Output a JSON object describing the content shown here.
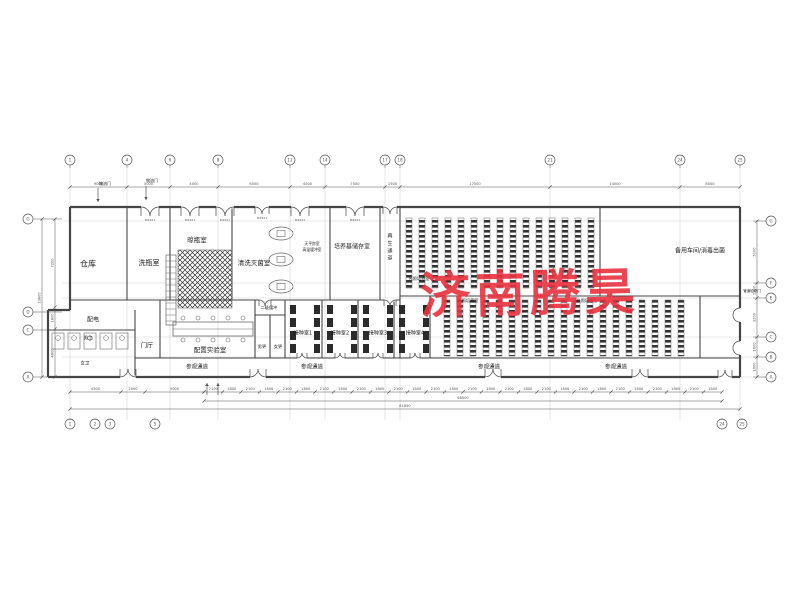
{
  "watermark": {
    "text": "济南腾昊",
    "color": "#ea3140"
  },
  "plan": {
    "colors": {
      "wall": "#454545",
      "thin": "#6a6a6a",
      "grid": "#c9c9c9",
      "dim": "#555555",
      "text": "#1a1a1a",
      "hatch": "#333333"
    },
    "door_tag": "M1521",
    "axes": {
      "top": {
        "y": 160,
        "items": [
          {
            "x": 70,
            "l": "1"
          },
          {
            "x": 127,
            "l": "4"
          },
          {
            "x": 170,
            "l": "6"
          },
          {
            "x": 218,
            "l": "8"
          },
          {
            "x": 290,
            "l": "12"
          },
          {
            "x": 325,
            "l": "14"
          },
          {
            "x": 385,
            "l": "17"
          },
          {
            "x": 400,
            "l": "18"
          },
          {
            "x": 550,
            "l": "21"
          },
          {
            "x": 680,
            "l": "24"
          },
          {
            "x": 740,
            "l": "25"
          }
        ]
      },
      "bottom": {
        "y": 424,
        "items": [
          {
            "x": 70,
            "l": "1"
          },
          {
            "x": 95,
            "l": "2"
          },
          {
            "x": 110,
            "l": "3"
          },
          {
            "x": 155,
            "l": "5"
          },
          {
            "x": 722,
            "l": "24"
          },
          {
            "x": 742,
            "l": "25"
          }
        ]
      },
      "left": {
        "x": 28,
        "items": [
          {
            "y": 219,
            "l": "G"
          },
          {
            "y": 312,
            "l": "D"
          },
          {
            "y": 330,
            "l": "C"
          },
          {
            "y": 377,
            "l": "A"
          }
        ]
      },
      "right": {
        "x": 771,
        "items": [
          {
            "y": 221,
            "l": "G"
          },
          {
            "y": 283,
            "l": "F"
          },
          {
            "y": 298,
            "l": "E"
          },
          {
            "y": 337,
            "l": "C"
          },
          {
            "y": 357,
            "l": "B"
          },
          {
            "y": 377,
            "l": "A"
          }
        ]
      }
    },
    "dims": {
      "top": {
        "y": 187,
        "xs": [
          70,
          127,
          170,
          218,
          290,
          325,
          385,
          400,
          550,
          680,
          740
        ],
        "labels": [
          "9000",
          "5000",
          "4000",
          "6000",
          "4500",
          "7500",
          "1500",
          "17500",
          "14000",
          "8000"
        ]
      },
      "bottom_left": {
        "y": 392,
        "xs": [
          70,
          121,
          145,
          204
        ],
        "labels": [
          "4300",
          "2000",
          "5000"
        ]
      },
      "bottom_fine": {
        "y": 392,
        "x1": 204,
        "x2": 722,
        "n": 28,
        "alt": [
          "2100",
          "1800"
        ]
      },
      "bottom_mid": {
        "y": 401,
        "xs": [
          204,
          722
        ],
        "labels": [
          "68500"
        ]
      },
      "bottom_total": {
        "y": 409,
        "xs": [
          70,
          740
        ],
        "labels": [
          "81850"
        ]
      },
      "left": {
        "x": 55,
        "ys": [
          219,
          307,
          329,
          377
        ],
        "labels": [
          "7200",
          "1800",
          "4800"
        ]
      },
      "left_total": {
        "x": 42,
        "ys": [
          219,
          377
        ],
        "labels": [
          "13800"
        ]
      },
      "right": {
        "x": 757,
        "ys": [
          221,
          283,
          298,
          337,
          357,
          377
        ],
        "labels": [
          "5100",
          "1200",
          "3200",
          "1600",
          "1600"
        ]
      }
    },
    "walls": [
      [
        70,
        207,
        740,
        207,
        1
      ],
      [
        740,
        207,
        740,
        377,
        1
      ],
      [
        70,
        377,
        740,
        377,
        1
      ],
      [
        70,
        207,
        70,
        310,
        1
      ],
      [
        48,
        310,
        70,
        310,
        1
      ],
      [
        48,
        310,
        48,
        377,
        1
      ],
      [
        48,
        377,
        70,
        377,
        1
      ],
      [
        127,
        207,
        127,
        300,
        0
      ],
      [
        170,
        207,
        170,
        300,
        0
      ],
      [
        232,
        207,
        232,
        300,
        0
      ],
      [
        330,
        207,
        330,
        300,
        0
      ],
      [
        380,
        207,
        380,
        300,
        0
      ],
      [
        400,
        207,
        400,
        358,
        0
      ],
      [
        600,
        207,
        600,
        296,
        0
      ],
      [
        70,
        300,
        400,
        300,
        0
      ],
      [
        400,
        296,
        740,
        296,
        0
      ],
      [
        135,
        310,
        135,
        377,
        0
      ],
      [
        48,
        330,
        135,
        330,
        0
      ],
      [
        160,
        300,
        160,
        358,
        0
      ],
      [
        255,
        300,
        255,
        358,
        0
      ],
      [
        285,
        300,
        285,
        358,
        0
      ],
      [
        322,
        300,
        322,
        358,
        0
      ],
      [
        358,
        300,
        358,
        358,
        0
      ],
      [
        394,
        300,
        394,
        358,
        0
      ],
      [
        430,
        296,
        430,
        358,
        0
      ],
      [
        700,
        296,
        700,
        358,
        0
      ],
      [
        255,
        315,
        285,
        315,
        0
      ],
      [
        270,
        315,
        270,
        358,
        0
      ],
      [
        135,
        358,
        740,
        358,
        0
      ]
    ],
    "racks": {
      "groups": [
        {
          "x1": 406,
          "x2": 594,
          "y1": 218,
          "y2": 288,
          "pitch": 13,
          "w": 6
        },
        {
          "x1": 444,
          "x2": 688,
          "y1": 300,
          "y2": 356,
          "pitch": 13,
          "w": 6
        }
      ]
    },
    "fixtures": {
      "crosshatch": {
        "x": 178,
        "y": 250,
        "w": 54,
        "h": 58
      },
      "ladders": [
        {
          "x": 166,
          "y": 255,
          "w": 10,
          "h": 70
        }
      ],
      "bench": {
        "x": 173,
        "y": 322,
        "w": 80,
        "h": 14
      },
      "autoclaves": [
        {
          "x": 269,
          "y": 227,
          "w": 24,
          "h": 13
        },
        {
          "x": 269,
          "y": 253,
          "w": 24,
          "h": 13
        },
        {
          "x": 269,
          "y": 280,
          "w": 24,
          "h": 13
        }
      ],
      "stalls": {
        "x": 52,
        "y": 333,
        "n": 5,
        "pitch": 16,
        "w": 12,
        "h": 16
      },
      "benches_small": {
        "rooms": [
          287,
          324,
          360,
          396
        ],
        "cols": [
          3,
          27
        ],
        "y": 305,
        "n": 4,
        "pitch": 13,
        "w": 6,
        "h": 9
      }
    },
    "doors": [
      {
        "x": 150,
        "y": 207,
        "o": "d",
        "w": 9,
        "tag": 1
      },
      {
        "x": 190,
        "y": 207,
        "o": "d",
        "w": 9,
        "tag": 1
      },
      {
        "x": 225,
        "y": 207,
        "o": "d",
        "w": 9,
        "tag": 1
      },
      {
        "x": 262,
        "y": 207,
        "o": "d",
        "w": 7,
        "tag": 1
      },
      {
        "x": 300,
        "y": 207,
        "o": "d",
        "w": 9,
        "tag": 1
      },
      {
        "x": 355,
        "y": 207,
        "o": "d",
        "w": 9,
        "tag": 1
      },
      {
        "x": 390,
        "y": 207,
        "o": "d",
        "w": 7,
        "tag": 0
      },
      {
        "x": 128,
        "y": 377,
        "o": "u",
        "w": 8,
        "tag": 0
      },
      {
        "x": 258,
        "y": 377,
        "o": "u",
        "w": 8,
        "tag": 0
      },
      {
        "x": 493,
        "y": 377,
        "o": "u",
        "w": 8,
        "tag": 0
      },
      {
        "x": 640,
        "y": 377,
        "o": "u",
        "w": 8,
        "tag": 0
      },
      {
        "x": 725,
        "y": 377,
        "o": "u",
        "w": 7,
        "tag": 0
      },
      {
        "x": 740,
        "y": 315,
        "o": "l",
        "w": 7,
        "tag": 0
      },
      {
        "x": 740,
        "y": 348,
        "o": "l",
        "w": 7,
        "tag": 0
      },
      {
        "x": 265,
        "y": 300,
        "o": "d",
        "w": 6,
        "tag": 0
      },
      {
        "x": 390,
        "y": 300,
        "o": "d",
        "w": 6,
        "tag": 0
      },
      {
        "x": 302,
        "y": 358,
        "o": "u",
        "w": 5,
        "tag": 0
      },
      {
        "x": 340,
        "y": 358,
        "o": "u",
        "w": 5,
        "tag": 0
      },
      {
        "x": 378,
        "y": 358,
        "o": "u",
        "w": 5,
        "tag": 0
      },
      {
        "x": 415,
        "y": 358,
        "o": "u",
        "w": 5,
        "tag": 0
      }
    ],
    "arrows": [
      {
        "x1": 98,
        "y1": 188,
        "x2": 98,
        "y2": 202
      },
      {
        "x1": 146,
        "y1": 186,
        "x2": 146,
        "y2": 200
      },
      {
        "x1": 207,
        "y1": 395,
        "x2": 207,
        "y2": 383
      },
      {
        "x1": 218,
        "y1": 395,
        "x2": 218,
        "y2": 383
      }
    ],
    "labels": [
      {
        "t": "仓库",
        "x": 88,
        "y": 264,
        "s": 8
      },
      {
        "t": "洗瓶室",
        "x": 149,
        "y": 263,
        "s": 7
      },
      {
        "t": "晾瓶室",
        "x": 197,
        "y": 240,
        "s": 6.5
      },
      {
        "t": "清洗灭菌室",
        "x": 254,
        "y": 263,
        "s": 6.5
      },
      {
        "t": "天平房室",
        "x": 312,
        "y": 244,
        "s": 3.8
      },
      {
        "t": "高温缓冲室",
        "x": 312,
        "y": 250,
        "s": 3.8
      },
      {
        "t": "培养基储存室",
        "x": 352,
        "y": 247,
        "s": 6
      },
      {
        "t": "再生通道",
        "x": 390,
        "y": 236,
        "s": 5,
        "v": 1
      },
      {
        "t": "光照培养室",
        "x": 419,
        "y": 279,
        "s": 4.2
      },
      {
        "t": "光照培养室",
        "x": 468,
        "y": 301,
        "s": 4.2
      },
      {
        "t": "光照培养室",
        "x": 587,
        "y": 301,
        "s": 4.2
      },
      {
        "t": "备用车间/消毒出菌",
        "x": 700,
        "y": 251,
        "s": 6
      },
      {
        "t": "配电",
        "x": 93,
        "y": 320,
        "s": 6
      },
      {
        "t": "男卫",
        "x": 88,
        "y": 338,
        "s": 4.5
      },
      {
        "t": "女卫",
        "x": 85,
        "y": 363,
        "s": 4.5
      },
      {
        "t": "门厅",
        "x": 147,
        "y": 346,
        "s": 6
      },
      {
        "t": "配置实验室",
        "x": 210,
        "y": 350,
        "s": 6.5
      },
      {
        "t": "二级缓冲",
        "x": 269,
        "y": 308,
        "s": 4.2
      },
      {
        "t": "男更",
        "x": 262,
        "y": 347,
        "s": 4.2
      },
      {
        "t": "女更",
        "x": 278,
        "y": 347,
        "s": 4.2
      },
      {
        "t": "接种室1",
        "x": 303,
        "y": 333,
        "s": 5
      },
      {
        "t": "接种室2",
        "x": 340,
        "y": 333,
        "s": 5
      },
      {
        "t": "接种室3",
        "x": 378,
        "y": 333,
        "s": 5
      },
      {
        "t": "接种室4",
        "x": 415,
        "y": 333,
        "s": 5
      },
      {
        "t": "参观通道",
        "x": 197,
        "y": 367,
        "s": 5.5
      },
      {
        "t": "参观通道",
        "x": 312,
        "y": 367,
        "s": 5.5
      },
      {
        "t": "参观通道",
        "x": 489,
        "y": 367,
        "s": 5.5
      },
      {
        "t": "参观通道",
        "x": 616,
        "y": 367,
        "s": 5.5
      },
      {
        "t": "物流门",
        "x": 105,
        "y": 184,
        "s": 4
      },
      {
        "t": "物流门",
        "x": 152,
        "y": 181,
        "s": 4
      },
      {
        "t": "管道检修门",
        "x": 752,
        "y": 291,
        "s": 3.5
      }
    ]
  }
}
